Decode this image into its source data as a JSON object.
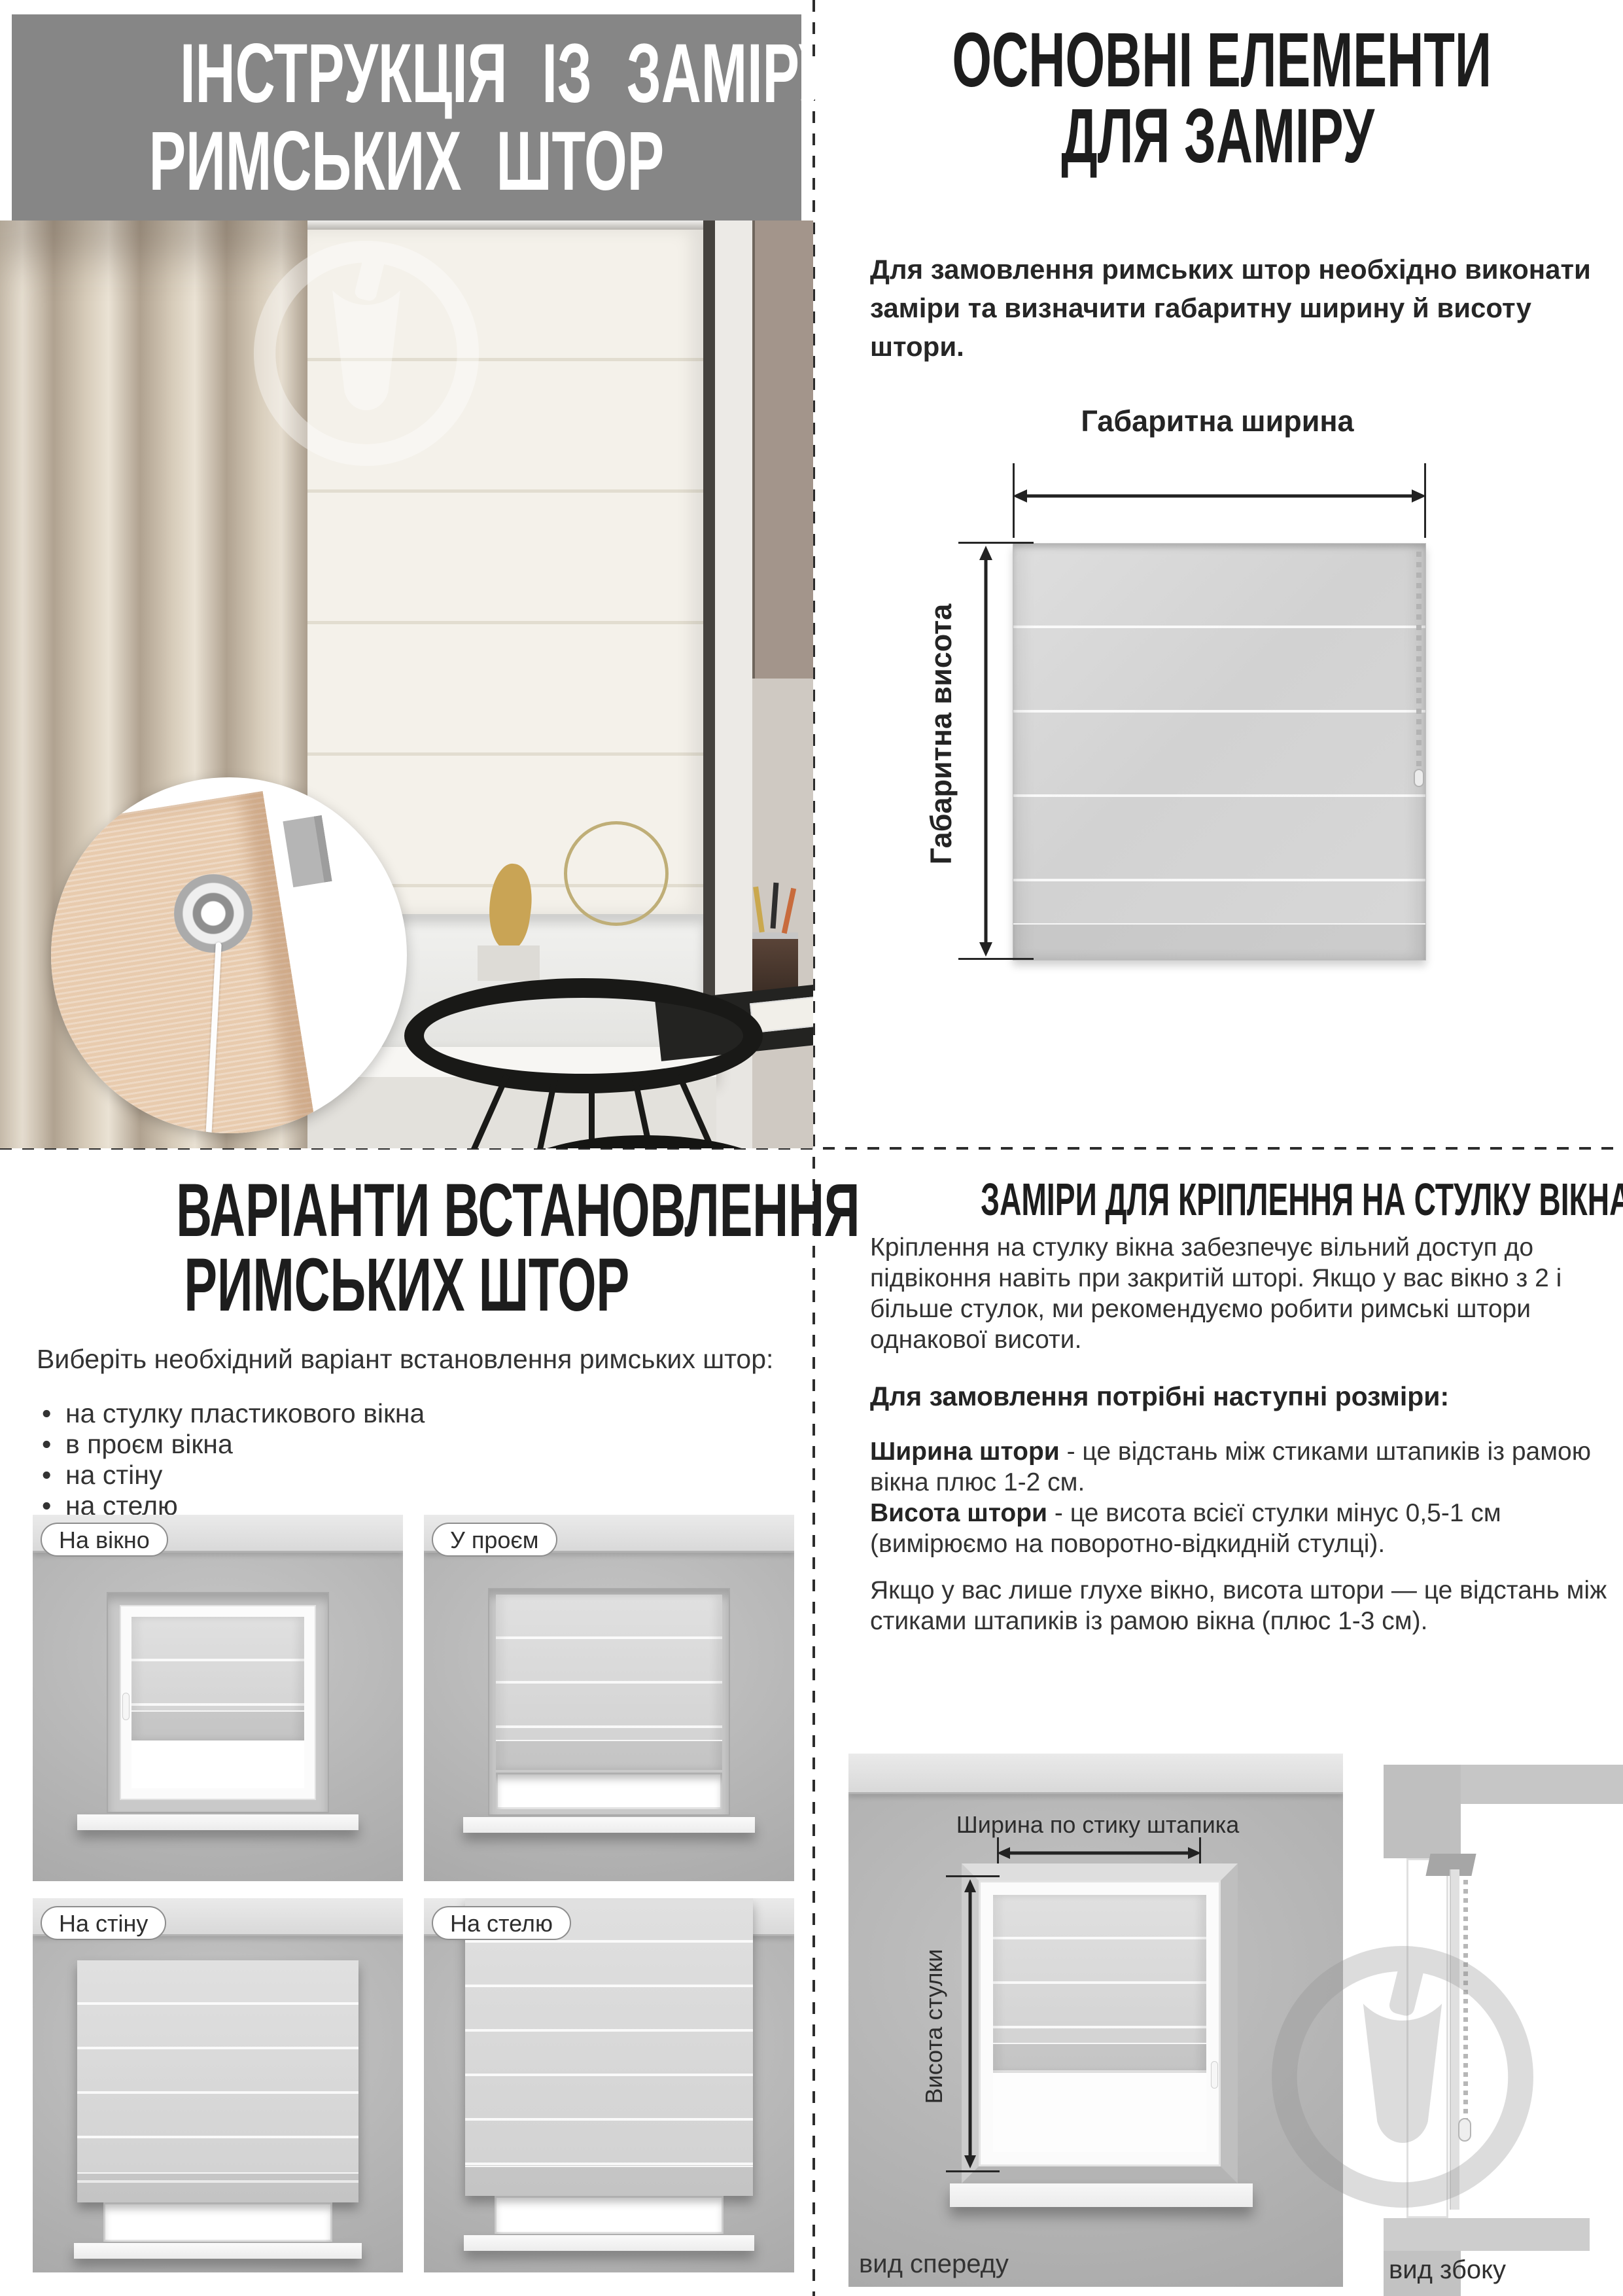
{
  "top_left": {
    "title_line1": "ІНСТРУКЦІЯ ІЗ ЗАМІРУ",
    "title_line2": "РИМСЬКИХ ШТОР"
  },
  "top_right": {
    "title_line1": "ОСНОВНІ ЕЛЕМЕНТИ",
    "title_line2": "ДЛЯ ЗАМІРУ",
    "intro": "Для замовлення римських штор необхідно виконати заміри та визначити габаритну ширину й висоту штори.",
    "diagram": {
      "width_label": "Габаритна ширина",
      "height_label": "Габаритна висота"
    }
  },
  "bottom_left": {
    "title_line1": "ВАРІАНТИ ВСТАНОВЛЕННЯ",
    "title_line2": "РИМСЬКИХ ШТОР",
    "intro": "Виберіть необхідний варіант встановлення римських штор:",
    "options": [
      "на стулку пластикового вікна",
      "в проєм вікна",
      "на стіну",
      "на стелю"
    ],
    "variants": [
      {
        "label": "На вікно"
      },
      {
        "label": "У проєм"
      },
      {
        "label": "На стіну"
      },
      {
        "label": "На стелю"
      }
    ]
  },
  "bottom_right": {
    "title": "ЗАМІРИ ДЛЯ КРІПЛЕННЯ НА СТУЛКУ ВІКНА",
    "p1": "Кріплення на стулку вікна забезпечує вільний доступ до підвіконня навіть при закритій шторі. Якщо у вас вікно з 2 і більше стулок, ми рекомендуємо робити римські штори однакової висоти.",
    "sizes_heading": "Для замовлення потрібні наступні розміри:",
    "width_term": "Ширина штори",
    "width_def": " - це відстань між стиками штапиків із рамою вікна плюс 1-2 см.",
    "height_term": "Висота штори",
    "height_def": " - це висота всієї стулки мінус 0,5-1 см (вимірюємо на поворотно-відкидній стулці).",
    "p3": "Якщо у вас лише глухе вікно, висота штори — це відстань між стиками штапиків із рамою вікна (плюс 1-3 см).",
    "diagram": {
      "width_label": "Ширина по стику штапика",
      "height_label": "Висота стулки",
      "front_caption": "вид спереду",
      "side_caption": "вид збоку"
    }
  },
  "colors": {
    "header_bg": "#868686",
    "title_ink": "#1d1d1d",
    "body_ink": "#333333",
    "wall": "#b4b4b4",
    "ceiling": "#d9d9d9",
    "blind": "#d5d5d5",
    "dash": "#2c2c2c",
    "curtain_beige": "#cfc3b1",
    "inset_beige": "#e8cbae",
    "taupe_wall": "#a3958b"
  }
}
